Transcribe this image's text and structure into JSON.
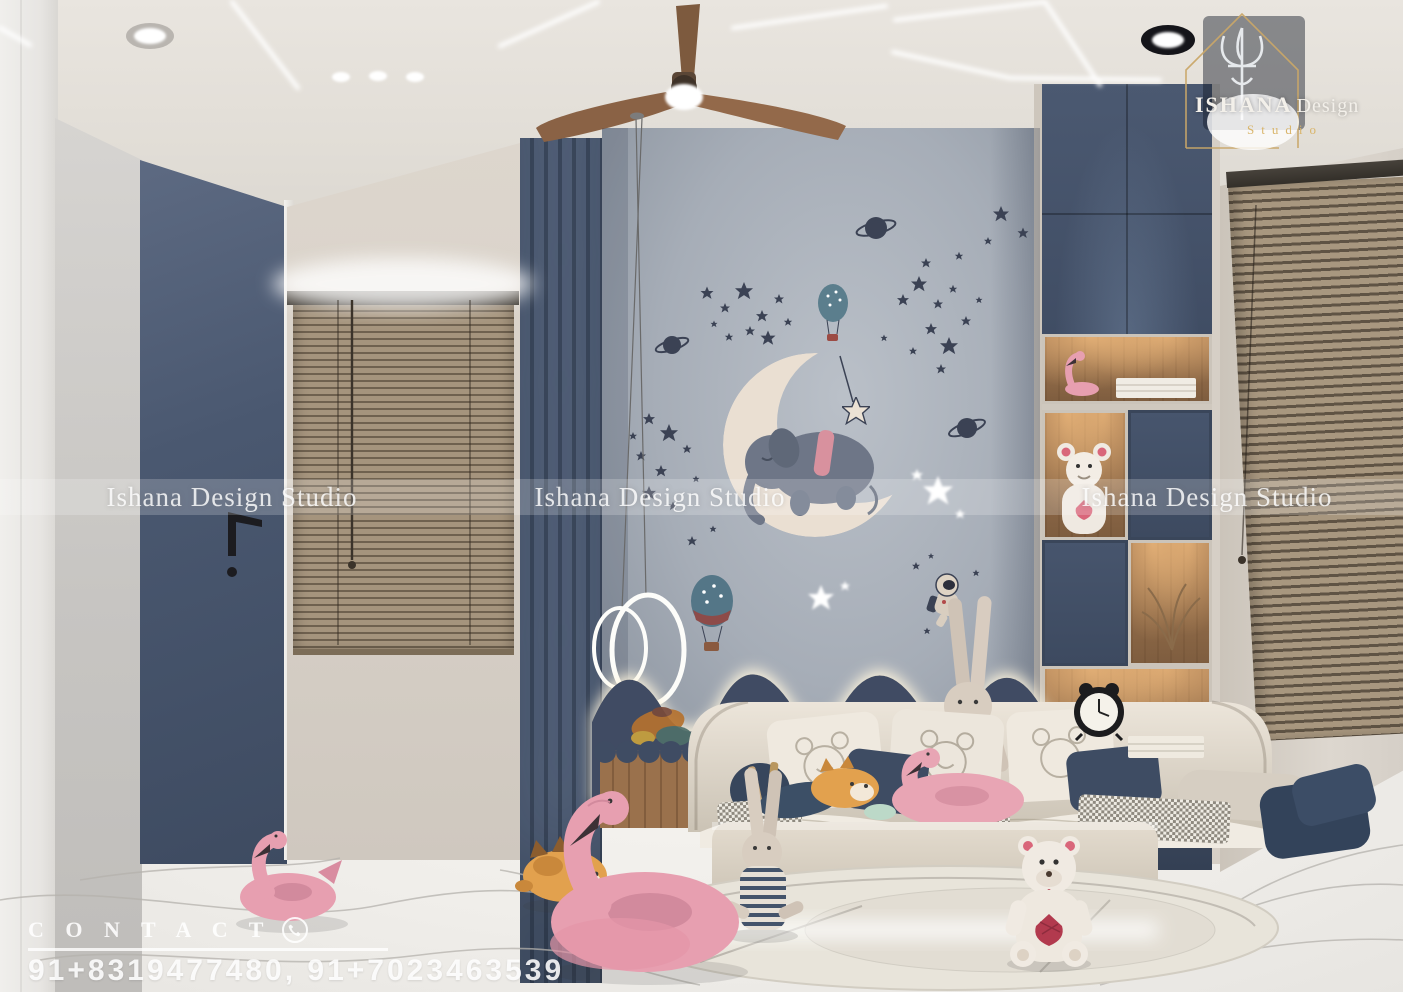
{
  "branding": {
    "logo": {
      "name": "ISHANA",
      "name2": "Design",
      "studio": "Studio",
      "icon": "trident-house-icon"
    }
  },
  "watermark": {
    "text": "Ishana Design Studio"
  },
  "contact": {
    "label": "C O N T A C T",
    "icon": "phone-icon",
    "numbers": "91+8319477480, 91+7023463539"
  },
  "palette": {
    "navy": "#41506a",
    "feature_wall_blue_gray": "#a6adb7",
    "wall_beige": "#d8d1c8",
    "blind_tan": "#a5947d",
    "wood": "#a97d54",
    "floor_marble": "#f2f0ec",
    "flamingo_pink": "#e79fb0",
    "moon_cream": "#eadfd2",
    "ceiling": "#e5e1db",
    "gold": "#c9a768",
    "glow_white": "#ffffff"
  },
  "scene_objects": [
    "ceiling-fan",
    "led-strip-lights",
    "recessed-spotlights",
    "ring-pendant-light",
    "wardrobe-mirror-door",
    "venetian-blind-window",
    "fluted-wall-panel",
    "moon-elephant-wall-decor",
    "star-wall-decals",
    "planet-decals",
    "hot-air-balloon-decals",
    "astronaut-decal",
    "wavy-headboard",
    "kids-daybed-sofa",
    "bear-print-cushions",
    "bed-bench",
    "toy-shelf-unit",
    "alarm-clock",
    "teddy-bear-plush",
    "bunny-plush",
    "flamingo-float",
    "cat-plush",
    "round-rug",
    "marble-floor"
  ]
}
